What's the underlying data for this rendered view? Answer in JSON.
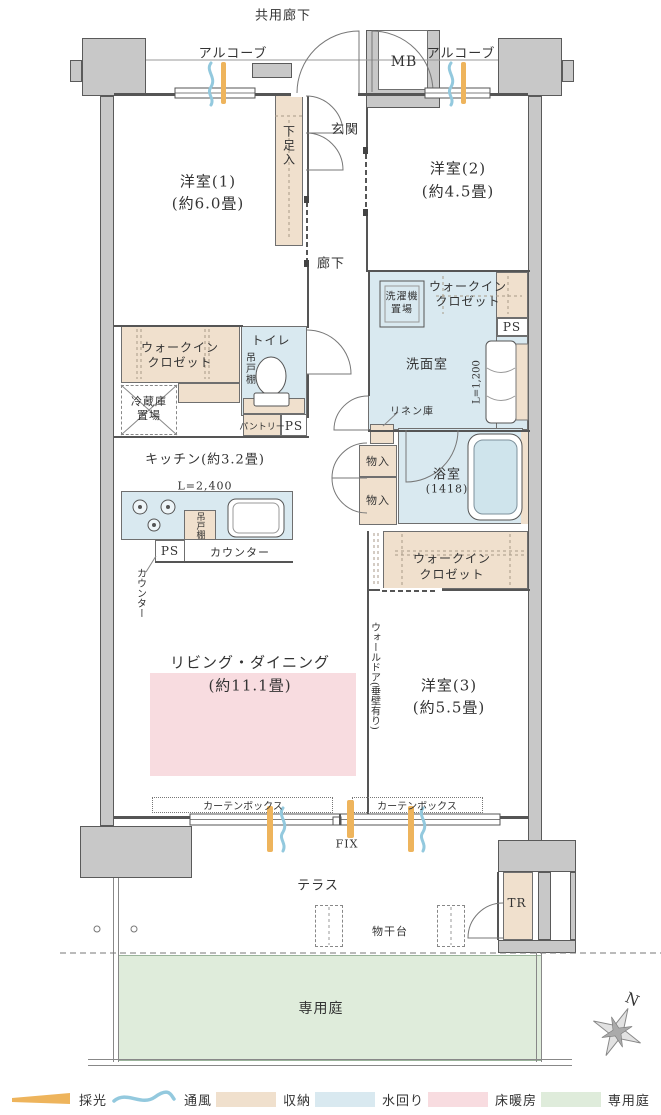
{
  "top": {
    "corridor": "共用廊下",
    "alcove_left": "アルコーブ",
    "alcove_right": "アルコーブ",
    "mb": "MB"
  },
  "entry": {
    "genkan": "玄関",
    "shoe": "下足入",
    "hall": "廊下"
  },
  "rooms": {
    "r1": {
      "name": "洋室(1)",
      "size": "(約6.0畳)"
    },
    "r2": {
      "name": "洋室(2)",
      "size": "(約4.5畳)"
    },
    "r3": {
      "name": "洋室(3)",
      "size": "(約5.5畳)"
    },
    "living": {
      "name": "リビング・ダイニング",
      "size": "(約11.1畳)",
      "wall_door": "ウォールドア(垂壁有り)"
    },
    "kitchen": {
      "name": "キッチン(約3.2畳)",
      "counter_len": "L=2,400",
      "ps": "PS",
      "counter_front": "カウンター",
      "counter_side": "カウンター",
      "hanging": "吊戸棚",
      "pantry": "パントリー",
      "pantry_ps": "PS",
      "fridge_l1": "冷蔵庫",
      "fridge_l2": "置場"
    },
    "toilet": {
      "name": "トイレ",
      "hanging": "吊戸棚"
    },
    "washroom": {
      "name": "洗面室",
      "washer_l1": "洗濯機",
      "washer_l2": "置場",
      "vanity_len": "L=1,200",
      "linen": "リネン庫"
    },
    "bath": {
      "name": "浴室",
      "size": "(1418)"
    }
  },
  "storage": {
    "wic1_l1": "ウォークイン",
    "wic1_l2": "クロゼット",
    "wic2_l1": "ウォークイン",
    "wic2_l2": "クロゼット",
    "wic2_ps": "PS",
    "wic3_l1": "ウォークイン",
    "wic3_l2": "クロゼット",
    "mono1": "物入",
    "mono2": "物入"
  },
  "openings": {
    "curtain_left": "カーテンボックス",
    "curtain_right": "カーテンボックス",
    "fix": "FIX"
  },
  "outdoor": {
    "terrace": "テラス",
    "drying": "物干台",
    "trunk": "TR",
    "garden": "専用庭"
  },
  "compass": {
    "north": "N"
  },
  "legend": {
    "daylight": "採光",
    "ventilation": "通風",
    "storage": "収納",
    "water": "水回り",
    "heating": "床暖房",
    "garden": "専用庭"
  },
  "colors": {
    "storage": "#f0e0cd",
    "water": "#d9e9f0",
    "floor_heating": "#f8dce0",
    "private_garden": "#dfecdb",
    "daylight": "#eeb45c",
    "ventilation": "#93c9de",
    "wall": "#c8c8c8"
  }
}
